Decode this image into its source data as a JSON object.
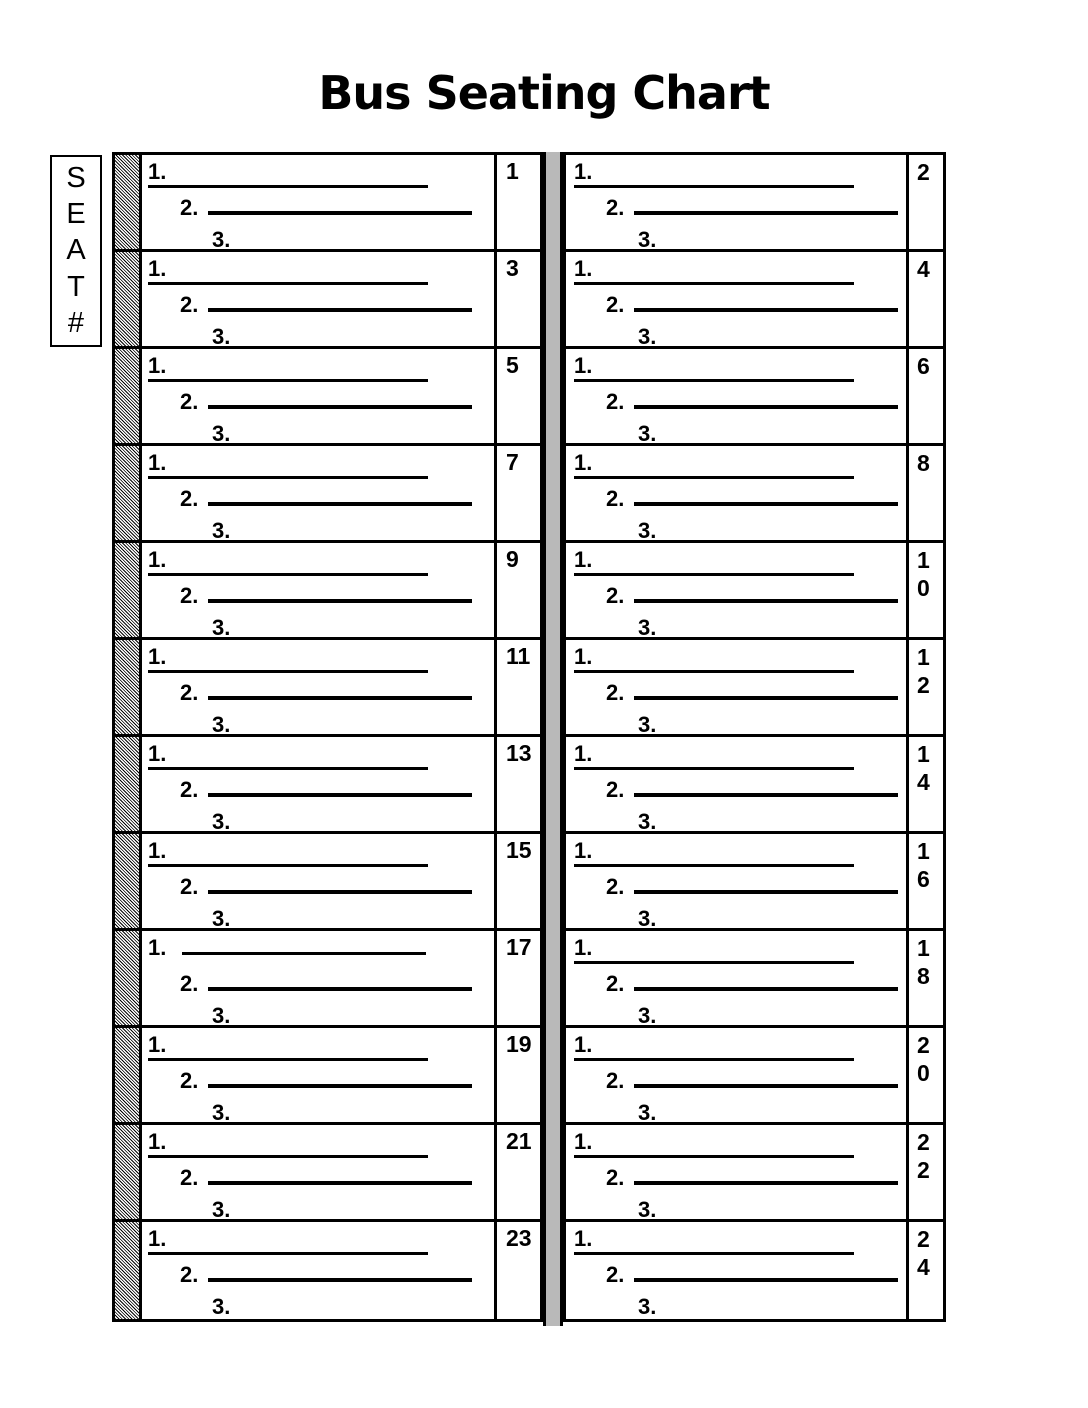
{
  "title": "Bus Seating Chart",
  "seat_header": {
    "label": "SEAT #",
    "letters": [
      "S",
      "E",
      "A",
      "T",
      "#"
    ]
  },
  "line_labels": [
    "1.",
    "2.",
    "3."
  ],
  "rows": [
    {
      "left_seat": "1",
      "right_seat": "2"
    },
    {
      "left_seat": "3",
      "right_seat": "4"
    },
    {
      "left_seat": "5",
      "right_seat": "6"
    },
    {
      "left_seat": "7",
      "right_seat": "8"
    },
    {
      "left_seat": "9",
      "right_seat": "10"
    },
    {
      "left_seat": "11",
      "right_seat": "12"
    },
    {
      "left_seat": "13",
      "right_seat": "14"
    },
    {
      "left_seat": "15",
      "right_seat": "16"
    },
    {
      "left_seat": "17",
      "right_seat": "18",
      "left_line1_detached": true
    },
    {
      "left_seat": "19",
      "right_seat": "20"
    },
    {
      "left_seat": "21",
      "right_seat": "22"
    },
    {
      "left_seat": "23",
      "right_seat": "24"
    }
  ],
  "colors": {
    "ink": "#000000",
    "paper": "#ffffff",
    "aisle_gray": "#b9b9b9"
  }
}
